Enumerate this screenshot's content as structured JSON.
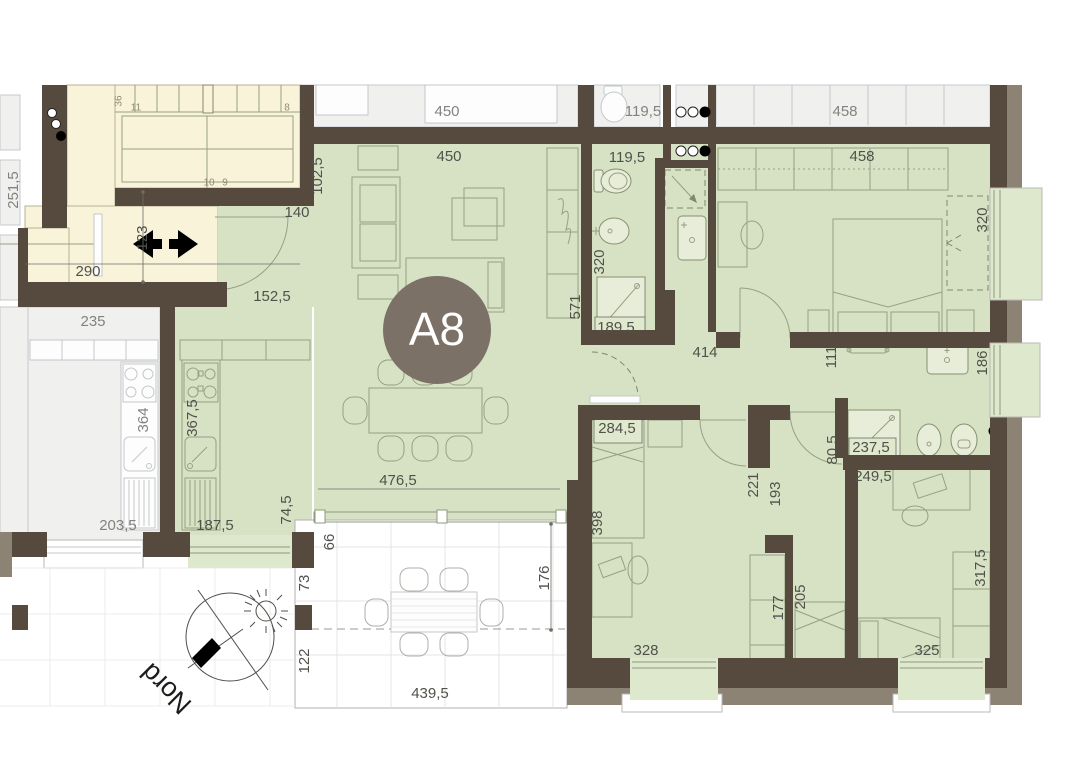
{
  "badge": {
    "label": "A8"
  },
  "compass": {
    "label": "Nord"
  },
  "colors": {
    "wall": "#56493E",
    "outer_wall": "#8C8375",
    "apartment_fill": "#D7E2C5",
    "sill_fill": "#DEE8CC",
    "stairwell_fill": "#F8F3D9",
    "neighbor_fill": "#F0F0EF",
    "badge_fill": "#7B7166",
    "badge_text": "#FFFFFF",
    "dim_text": "#51514B",
    "dim_text_muted": "#82827E"
  },
  "labels": [
    {
      "t": "450",
      "x": 447,
      "y": 112,
      "c": "m"
    },
    {
      "t": "119,5",
      "x": 643,
      "y": 112,
      "c": "m"
    },
    {
      "t": "458",
      "x": 845,
      "y": 112,
      "c": "m"
    },
    {
      "t": "450",
      "x": 449,
      "y": 157
    },
    {
      "t": "119,5",
      "x": 627,
      "y": 158
    },
    {
      "t": "458",
      "x": 862,
      "y": 157
    },
    {
      "t": "102,5",
      "x": 318,
      "y": 176,
      "r": -90
    },
    {
      "t": "140",
      "x": 297,
      "y": 213
    },
    {
      "t": "123",
      "x": 143,
      "y": 238,
      "r": -90
    },
    {
      "t": "290",
      "x": 88,
      "y": 272
    },
    {
      "t": "152,5",
      "x": 272,
      "y": 297
    },
    {
      "t": "251,5",
      "x": 14,
      "y": 190,
      "r": -90,
      "c": "m"
    },
    {
      "t": "235",
      "x": 93,
      "y": 322,
      "c": "m"
    },
    {
      "t": "364",
      "x": 144,
      "y": 420,
      "r": -90,
      "c": "m"
    },
    {
      "t": "203,5",
      "x": 118,
      "y": 526,
      "c": "m"
    },
    {
      "t": "367,5",
      "x": 193,
      "y": 418,
      "r": -90
    },
    {
      "t": "187,5",
      "x": 215,
      "y": 526
    },
    {
      "t": "74,5",
      "x": 287,
      "y": 510,
      "r": -90
    },
    {
      "t": "476,5",
      "x": 398,
      "y": 481
    },
    {
      "t": "66",
      "x": 330,
      "y": 542,
      "r": -90
    },
    {
      "t": "73",
      "x": 305,
      "y": 583,
      "r": -90
    },
    {
      "t": "122",
      "x": 305,
      "y": 661,
      "r": -90
    },
    {
      "t": "176",
      "x": 545,
      "y": 578,
      "r": -90
    },
    {
      "t": "439,5",
      "x": 430,
      "y": 694
    },
    {
      "t": "320",
      "x": 600,
      "y": 262,
      "r": -90
    },
    {
      "t": "571",
      "x": 576,
      "y": 307,
      "r": -90
    },
    {
      "t": "189,5",
      "x": 616,
      "y": 328
    },
    {
      "t": "414",
      "x": 705,
      "y": 353
    },
    {
      "t": "111",
      "x": 832,
      "y": 357,
      "r": -90
    },
    {
      "t": "320",
      "x": 983,
      "y": 220,
      "r": -90
    },
    {
      "t": "186",
      "x": 983,
      "y": 363,
      "r": -90
    },
    {
      "t": "284,5",
      "x": 617,
      "y": 429
    },
    {
      "t": "398",
      "x": 598,
      "y": 523,
      "r": -90
    },
    {
      "t": "221",
      "x": 754,
      "y": 485,
      "r": -90
    },
    {
      "t": "193",
      "x": 776,
      "y": 494,
      "r": -90
    },
    {
      "t": "177",
      "x": 779,
      "y": 608,
      "r": -90
    },
    {
      "t": "205",
      "x": 801,
      "y": 597,
      "r": -90
    },
    {
      "t": "328",
      "x": 646,
      "y": 651
    },
    {
      "t": "80,5",
      "x": 833,
      "y": 450,
      "r": -90
    },
    {
      "t": "237,5",
      "x": 871,
      "y": 448
    },
    {
      "t": "249,5",
      "x": 873,
      "y": 477
    },
    {
      "t": "317,5",
      "x": 981,
      "y": 568,
      "r": -90
    },
    {
      "t": "325",
      "x": 927,
      "y": 651
    },
    {
      "t": "36",
      "x": 119,
      "y": 101,
      "r": -90,
      "c": "stair"
    },
    {
      "t": "11",
      "x": 136,
      "y": 108,
      "c": "stair"
    },
    {
      "t": "8",
      "x": 287,
      "y": 108,
      "c": "stair"
    },
    {
      "t": "10",
      "x": 209,
      "y": 183,
      "c": "stair"
    },
    {
      "t": "9",
      "x": 225,
      "y": 183,
      "c": "stair"
    }
  ]
}
